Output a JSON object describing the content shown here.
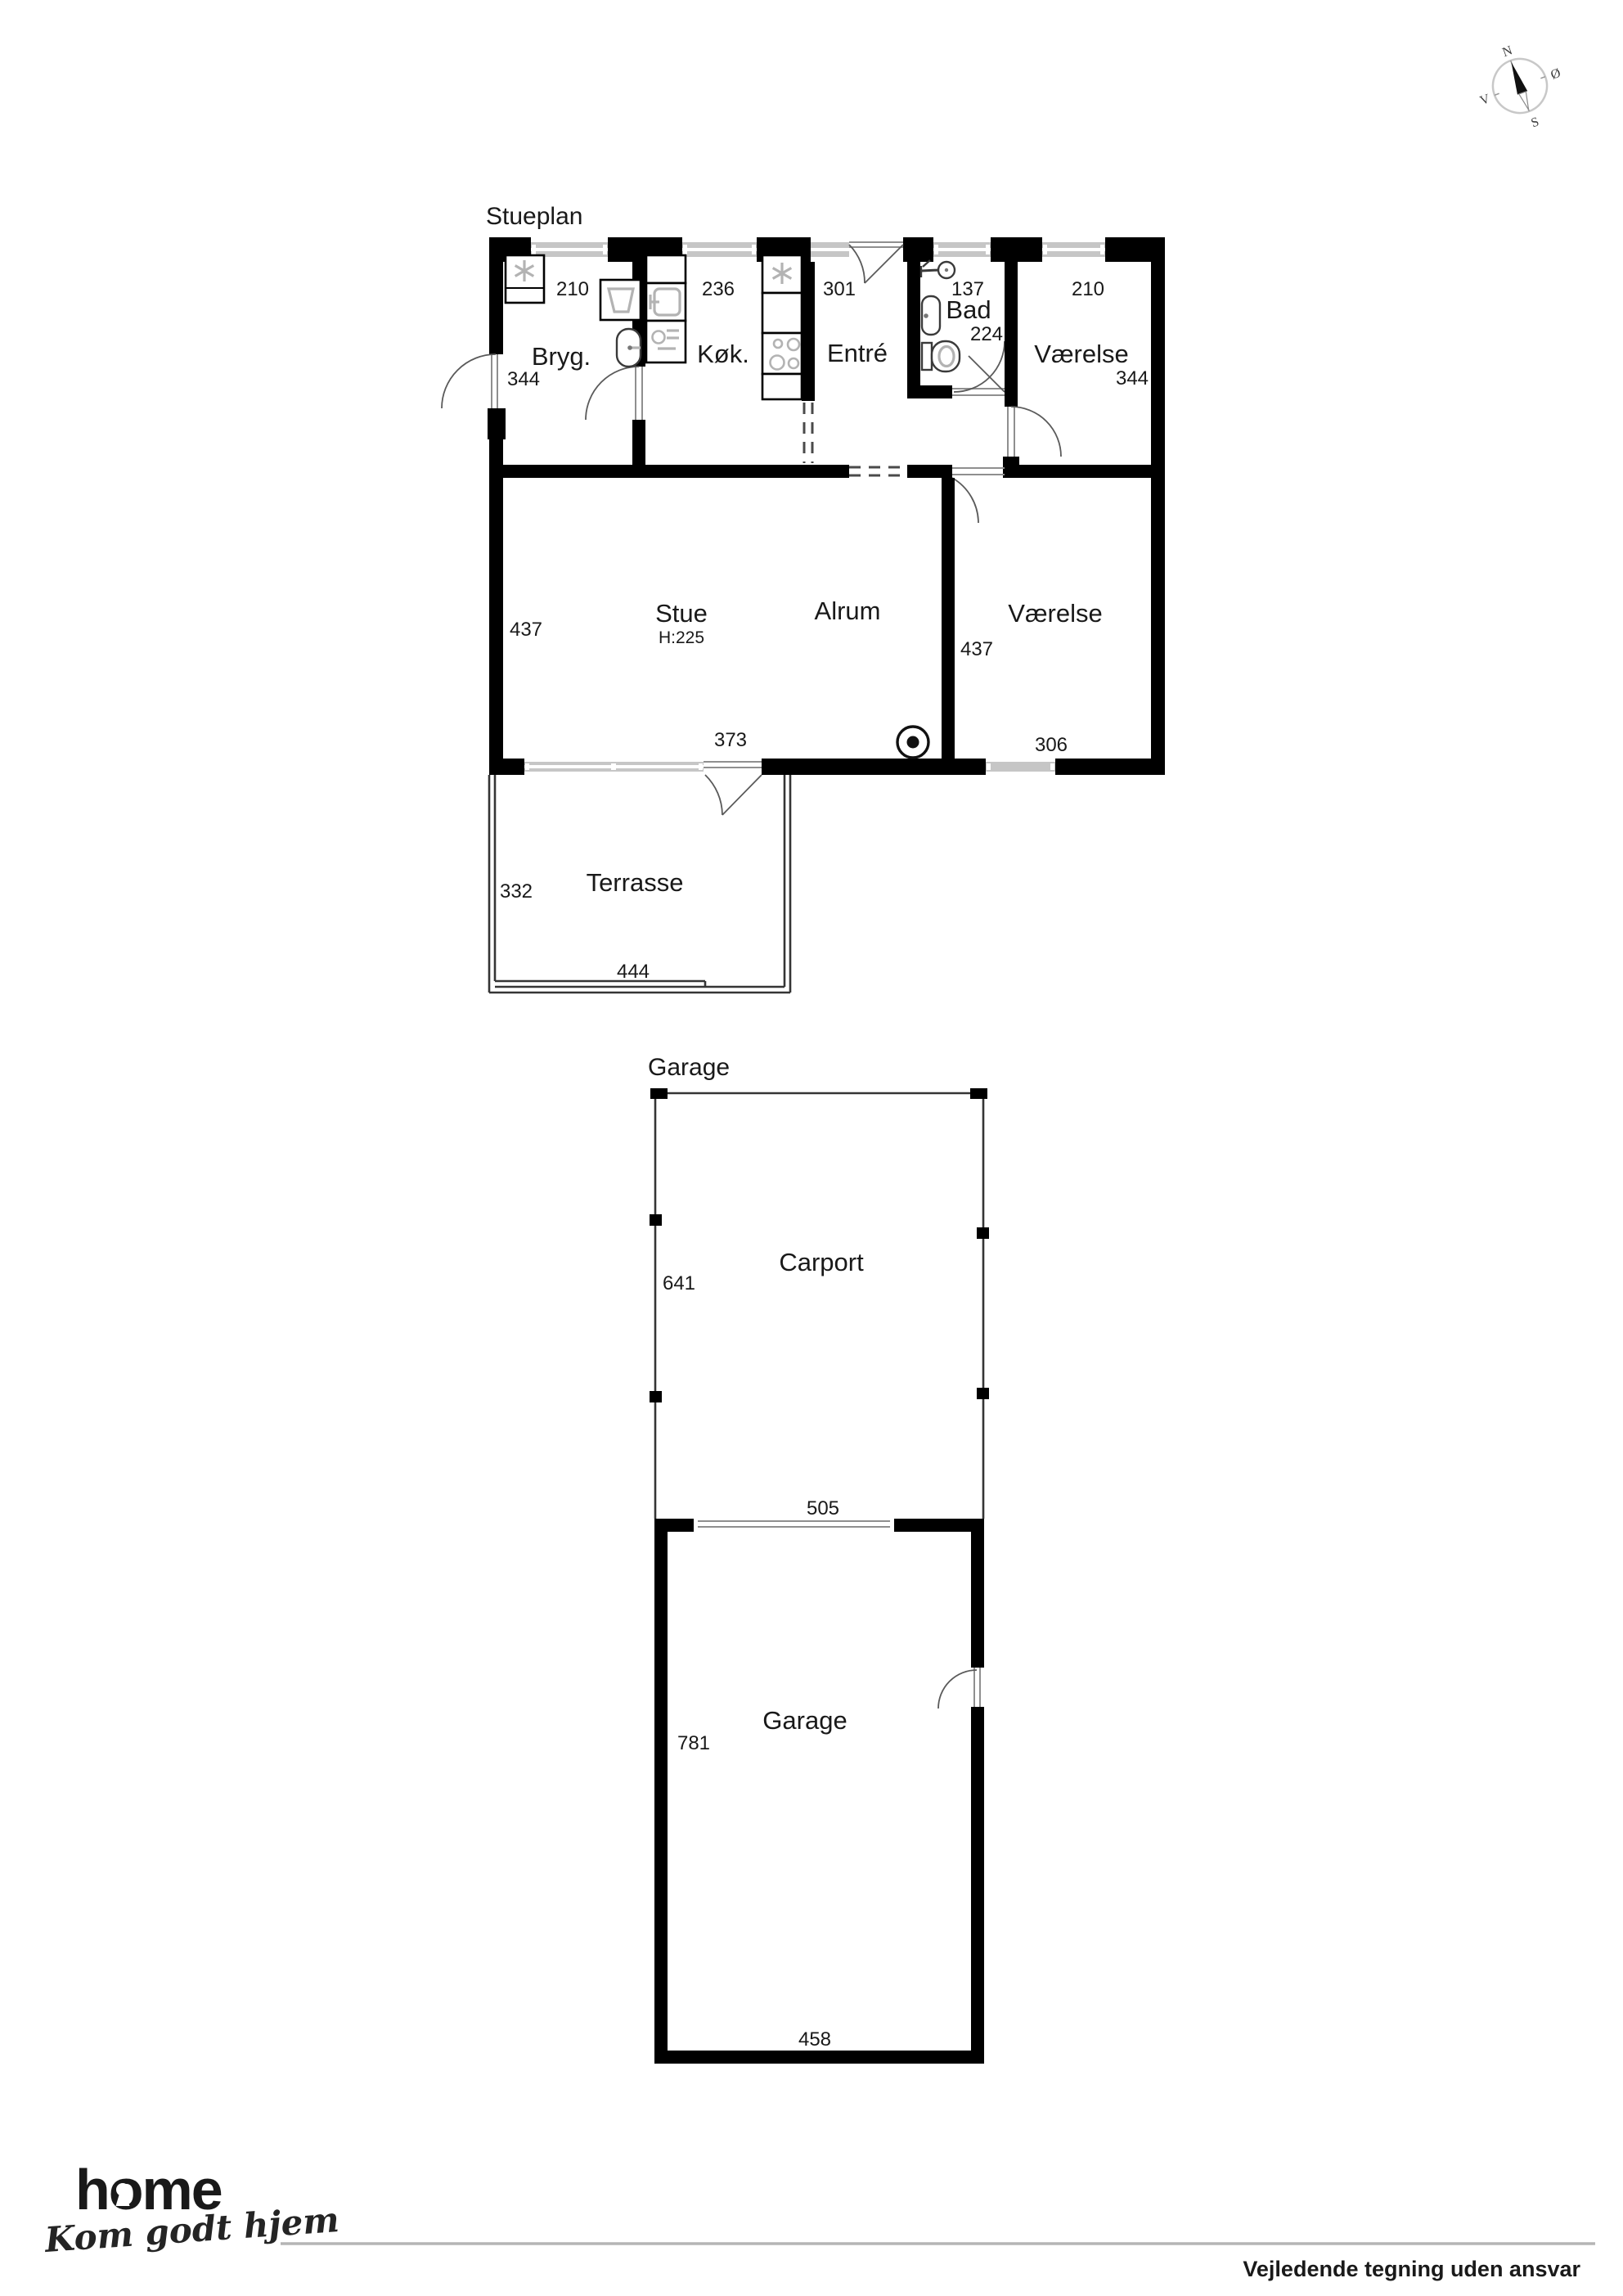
{
  "compass": {
    "north": "N",
    "east": "Ø",
    "south": "S",
    "west": "V"
  },
  "stueplan": {
    "title": "Stueplan",
    "rooms": {
      "bryg": "Bryg.",
      "kok": "Køk.",
      "entre": "Entré",
      "bad": "Bad",
      "vaerelse1": "Værelse",
      "stue": "Stue",
      "stue_height": "H:225",
      "alrum": "Alrum",
      "vaerelse2": "Værelse",
      "terrasse": "Terrasse"
    },
    "dims": {
      "bryg_w": "210",
      "bryg_h": "344",
      "kok_w": "236",
      "entre_w": "301",
      "bad_w": "137",
      "bad_h": "224",
      "vaerelse1_w": "210",
      "vaerelse1_h": "344",
      "stue_h": "437",
      "alrum_h": "437",
      "terrace_door_w": "373",
      "vaerelse2_w": "306",
      "terrasse_h": "332",
      "terrasse_w": "444"
    }
  },
  "garage": {
    "title": "Garage",
    "rooms": {
      "carport": "Carport",
      "garage": "Garage"
    },
    "dims": {
      "carport_h": "641",
      "carport_w": "505",
      "garage_h": "781",
      "garage_w": "458"
    }
  },
  "footer": {
    "logo": "home",
    "tagline": "Kom godt hjem",
    "disclaimer": "Vejledende tegning uden ansvar",
    "logo_color": "#e8222a"
  }
}
